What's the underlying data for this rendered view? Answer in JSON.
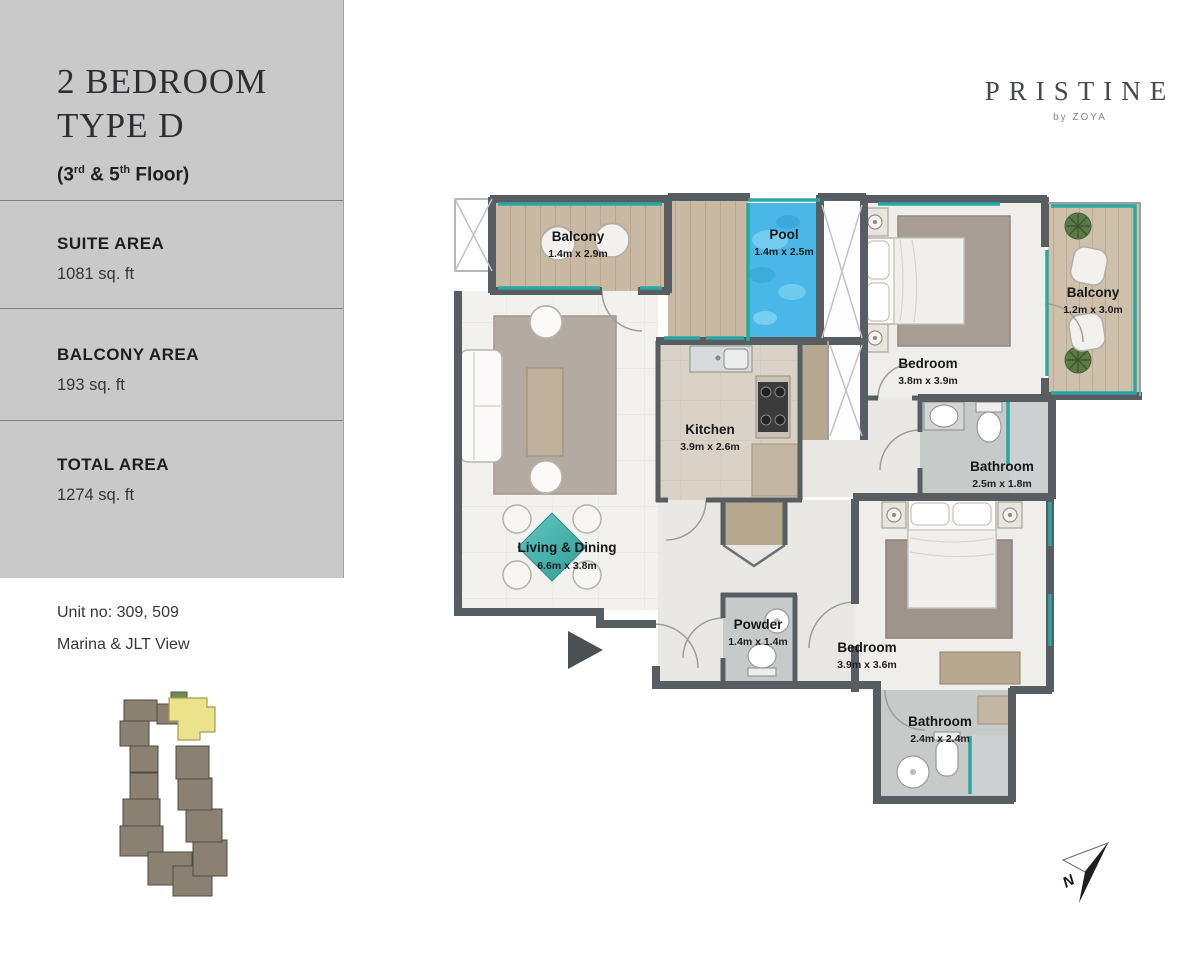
{
  "sidebar": {
    "title_lines": [
      "2 BEDROOM",
      "TYPE D"
    ],
    "floor_note": {
      "pre": "(3",
      "sup1": "rd",
      "mid": " & 5",
      "sup2": "th",
      "post": " Floor)"
    },
    "sections": [
      {
        "label": "SUITE AREA",
        "value": "1081 sq. ft"
      },
      {
        "label": "BALCONY AREA",
        "value": "193 sq. ft"
      },
      {
        "label": "TOTAL AREA",
        "value": "1274 sq. ft"
      }
    ]
  },
  "unit_info": {
    "unit_no": "Unit no: 309, 509",
    "view": "Marina & JLT View"
  },
  "logo": {
    "name": "PRISTINE",
    "byline": "by ZOYA"
  },
  "plan": {
    "rooms": [
      {
        "name": "Balcony",
        "dims": "1.4m x 2.9m"
      },
      {
        "name": "Pool",
        "dims": "1.4m x 2.5m"
      },
      {
        "name": "Bedroom",
        "dims": "3.8m x 3.9m"
      },
      {
        "name": "Balcony",
        "dims": "1.2m x 3.0m"
      },
      {
        "name": "Kitchen",
        "dims": "3.9m x 2.6m"
      },
      {
        "name": "Bathroom",
        "dims": "2.5m x 1.8m"
      },
      {
        "name": "Living & Dining",
        "dims": "6.6m x 3.8m"
      },
      {
        "name": "Powder",
        "dims": "1.4m x 1.4m"
      },
      {
        "name": "Bedroom",
        "dims": "3.9m x 3.6m"
      },
      {
        "name": "Bathroom",
        "dims": "2.4m x 2.4m"
      }
    ],
    "compass_label": "N"
  },
  "colors": {
    "sidebar_bg": "#c9c9c9",
    "wall": "#585d62",
    "wood": "#c9b8a2",
    "pool_water": "#49b8e8",
    "glass": "#2ba7a3",
    "bath_floor": "#c6cac9",
    "keyplan_building": "#8b8173",
    "keyplan_highlight": "#ece28c",
    "keyplan_green": "#6d8b4a"
  }
}
